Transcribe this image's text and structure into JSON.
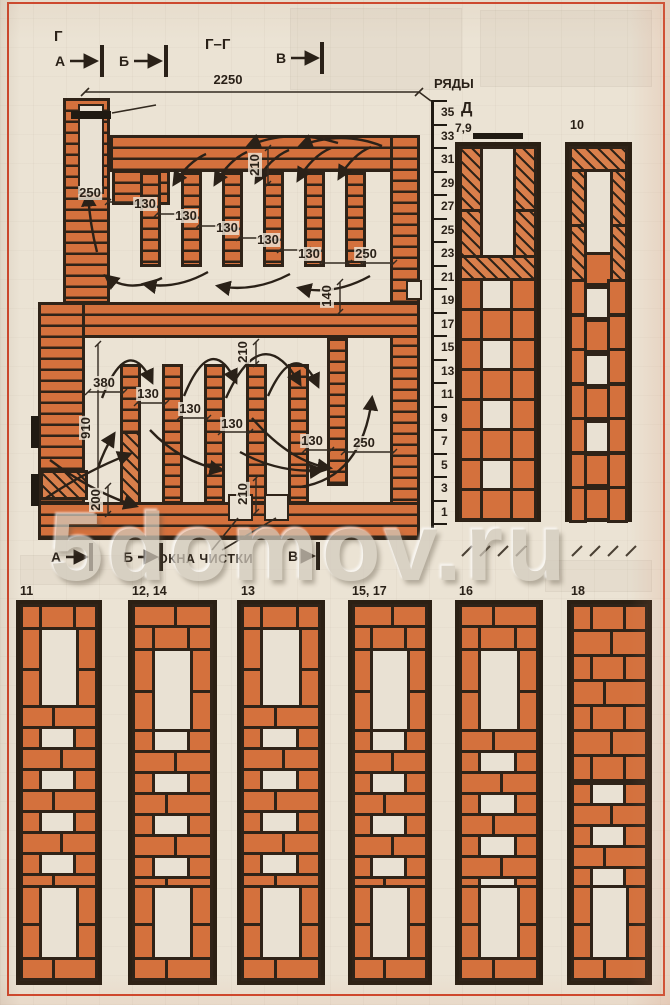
{
  "page": {
    "watermark": "5domov.ru"
  },
  "section_view": {
    "title": "Г–Г",
    "corner_label": "Г",
    "damper_callout": "7",
    "cleanout_label": "ОКНА ЧИСТКИ",
    "markers_top": [
      {
        "t": "А",
        "x": 60,
        "y": 61
      },
      {
        "t": "Б",
        "x": 124,
        "y": 61
      },
      {
        "t": "В",
        "x": 281,
        "y": 58
      }
    ],
    "markers_bottom": [
      {
        "t": "А",
        "x": 56,
        "y": 557
      },
      {
        "t": "Б",
        "x": 128,
        "y": 557
      },
      {
        "t": "В",
        "x": 293,
        "y": 556
      }
    ],
    "dims": [
      {
        "t": "2250",
        "x": 228,
        "y": 80
      },
      {
        "t": "250",
        "x": 90,
        "y": 193
      },
      {
        "t": "130",
        "x": 145,
        "y": 204
      },
      {
        "t": "130",
        "x": 186,
        "y": 216
      },
      {
        "t": "130",
        "x": 227,
        "y": 228
      },
      {
        "t": "130",
        "x": 268,
        "y": 240
      },
      {
        "t": "130",
        "x": 309,
        "y": 254
      },
      {
        "t": "250",
        "x": 366,
        "y": 254
      },
      {
        "t": "210",
        "x": 255,
        "y": 165,
        "rot": true
      },
      {
        "t": "140",
        "x": 327,
        "y": 296,
        "rot": true
      },
      {
        "t": "380",
        "x": 104,
        "y": 383
      },
      {
        "t": "130",
        "x": 148,
        "y": 394
      },
      {
        "t": "130",
        "x": 190,
        "y": 409
      },
      {
        "t": "130",
        "x": 232,
        "y": 424
      },
      {
        "t": "130",
        "x": 312,
        "y": 441
      },
      {
        "t": "250",
        "x": 364,
        "y": 443
      },
      {
        "t": "910",
        "x": 86,
        "y": 428,
        "rot": true
      },
      {
        "t": "200",
        "x": 96,
        "y": 500,
        "rot": true
      },
      {
        "t": "210",
        "x": 243,
        "y": 352,
        "rot": true
      },
      {
        "t": "210",
        "x": 243,
        "y": 494,
        "rot": true
      }
    ]
  },
  "scale": {
    "title": "РЯДЫ",
    "rows": [
      "35",
      "33",
      "31",
      "29",
      "27",
      "25",
      "23",
      "21",
      "19",
      "17",
      "15",
      "13",
      "11",
      "9",
      "7",
      "5",
      "3",
      "1"
    ]
  },
  "course_plans_right": [
    {
      "label": "Д",
      "sub": "7,9"
    },
    {
      "label": "10"
    }
  ],
  "course_plans_bottom": [
    {
      "label": "11",
      "x": 16,
      "w": 86,
      "variant": "ring"
    },
    {
      "label": "12, 14",
      "x": 128,
      "w": 89,
      "variant": "band"
    },
    {
      "label": "13",
      "x": 237,
      "w": 88,
      "variant": "ring"
    },
    {
      "label": "15, 17",
      "x": 348,
      "w": 84,
      "variant": "band"
    },
    {
      "label": "16",
      "x": 455,
      "w": 88,
      "variant": "band"
    },
    {
      "label": "18",
      "x": 567,
      "w": 85,
      "variant": "solid"
    }
  ],
  "colors": {
    "brick": "#d4713d",
    "brick_light": "#d97f4b",
    "outline": "#2f2318",
    "paper": "#ebe3d4",
    "frame_red": "#cf4429"
  }
}
